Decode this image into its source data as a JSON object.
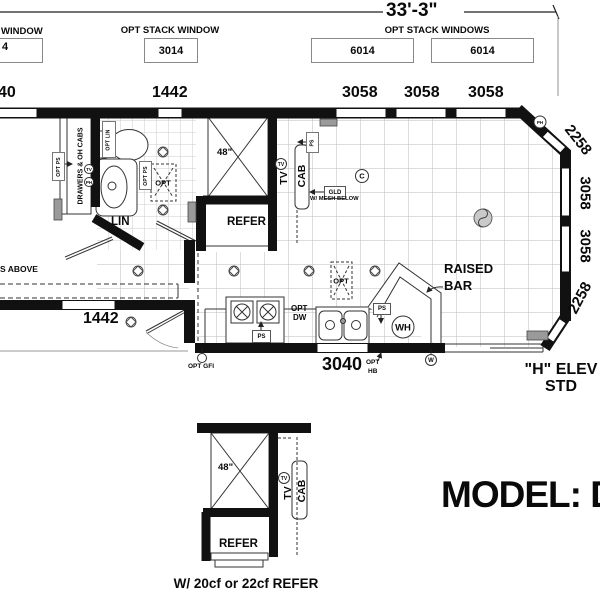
{
  "header": {
    "overall_width": "33'-3\""
  },
  "window_schedule": {
    "left_label": "WINDOW",
    "left_size": "4",
    "center_label": "OPT STACK WINDOW",
    "center_size": "3014",
    "right_label": "OPT STACK WINDOWS",
    "right_size_a": "6014",
    "right_size_b": "6014"
  },
  "top_dims": {
    "d40": "40",
    "d1442": "1442",
    "d3058_a": "3058",
    "d3058_b": "3058",
    "d3058_c": "3058"
  },
  "right_dims": {
    "top": "2258",
    "mid_a": "3058",
    "mid_b": "3058",
    "bottom": "2258"
  },
  "bottom_dims": {
    "d1442": "1442",
    "d3040": "3040"
  },
  "plan_labels": {
    "drawers": "DRAWERS & OH CABS",
    "opt_ps_left": "OPT PS",
    "opt_lin": "OPT LIN",
    "opt_ps_bath": "OPT PS",
    "opt_shower": "OPT",
    "lin": "LIN",
    "shower_48": "48\"",
    "tv": "TV",
    "cab": "CAB",
    "refer": "REFER",
    "ps_top": "PS",
    "gld": "GLD",
    "mesh": "W/ MESH BELOW",
    "opt_pantry": "OPT",
    "opt_dw_line1": "OPT",
    "opt_dw_line2": "DW",
    "ps_range": "PS",
    "ps_sink": "PS",
    "wh": "WH",
    "raised": "RAISED",
    "bar": "BAR",
    "opt_hb_line1": "OPT",
    "opt_hb_line2": "HB",
    "opt_gfi": "OPT GFI",
    "s_above": "S ABOVE"
  },
  "symbols": {
    "tv_left": "TV",
    "ph_left": "PH",
    "tv_kitchen": "TV",
    "c_circle": "C",
    "ph_corner": "PH",
    "w_circle": "W"
  },
  "elevation_note": {
    "line1": "\"H\" ELEV",
    "line2": "STD"
  },
  "model_title": "MODEL: D",
  "detail": {
    "shower": "48\"",
    "tv": "TV",
    "cab": "CAB",
    "tv_circle": "TV",
    "refer": "REFER",
    "caption": "W/ 20cf or 22cf REFER"
  },
  "colors": {
    "wall": "#111111",
    "grid_fine": "#cccccc",
    "grid_coarse": "#bbbbbb",
    "register": "#9a9a9a"
  }
}
